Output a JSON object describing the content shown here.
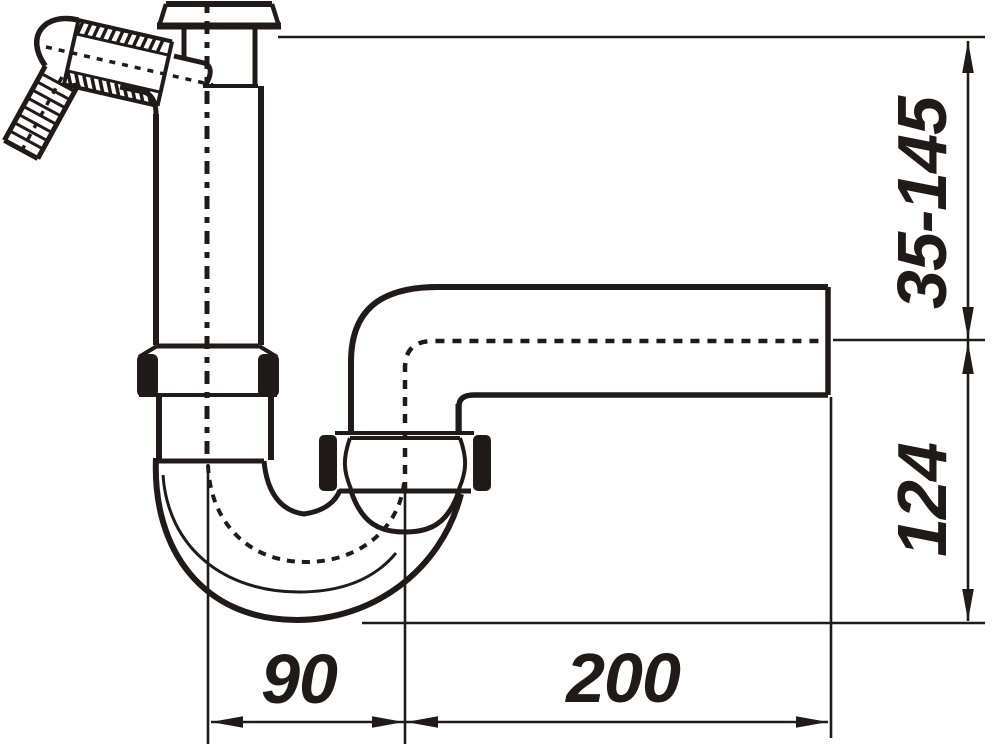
{
  "drawing": {
    "type": "technical-drawing",
    "subject": "siphon-trap-side-view",
    "background_color": "#ffffff",
    "line_color": "#201b18",
    "dimensions": {
      "height_range": {
        "label": "35-145",
        "orientation": "vertical"
      },
      "outlet_drop": {
        "label": "124",
        "orientation": "vertical"
      },
      "trap_width": {
        "label": "90",
        "orientation": "horizontal"
      },
      "outlet_length": {
        "label": "200",
        "orientation": "horizontal"
      }
    }
  }
}
